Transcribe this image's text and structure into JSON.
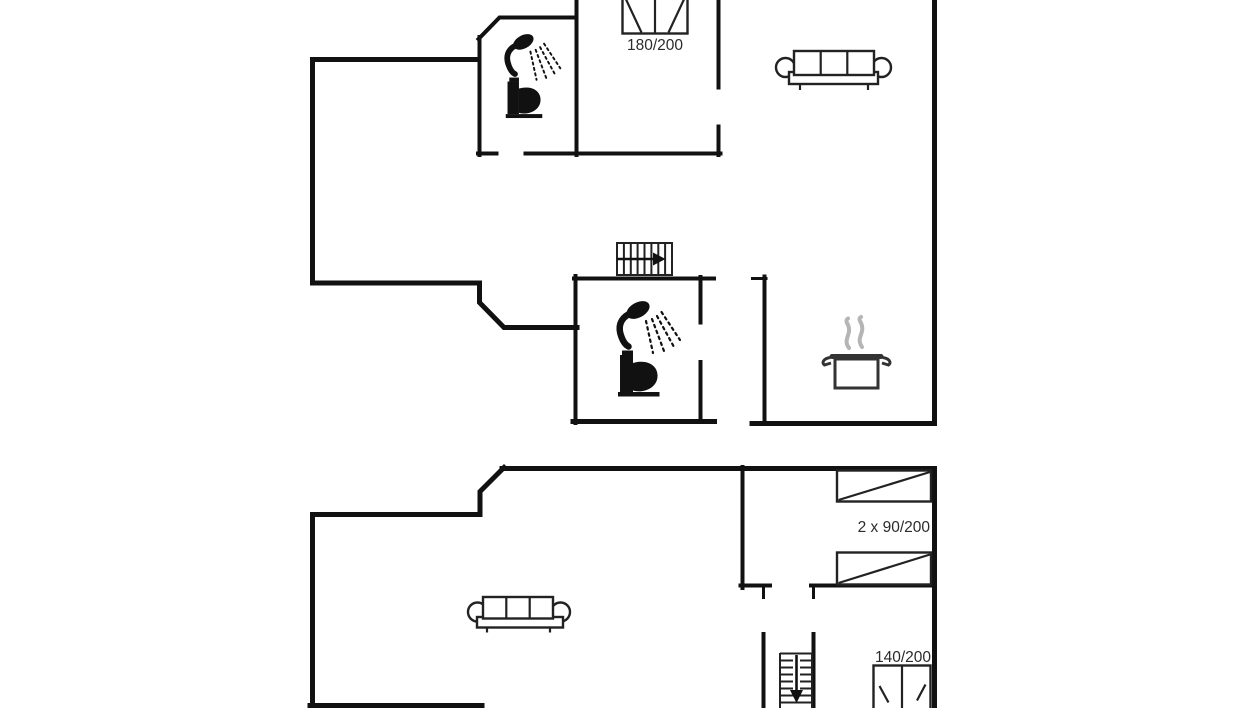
{
  "canvas": {
    "width": 1246,
    "height": 708,
    "background": "#ffffff"
  },
  "colors": {
    "wall": "#111111",
    "icon": "#111111",
    "furniture_outline": "#222222",
    "text": "#2b2b2b",
    "steam": "#b5b5b5",
    "pot_outline": "#333333"
  },
  "upper_floor": {
    "bed_double": {
      "size_label": "180/200",
      "icon": "double-bed-icon"
    },
    "bathroom_top": {
      "icons": [
        "shower-icon",
        "toilet-icon"
      ]
    },
    "bathroom_middle": {
      "icons": [
        "shower-icon",
        "toilet-icon"
      ]
    },
    "stairs": {
      "icon": "stairs-icon",
      "direction": "arrow-right"
    },
    "kitchen": {
      "icon": "cooking-pot-icon"
    },
    "living_area": {
      "icon": "sofa-icon"
    }
  },
  "lower_floor": {
    "bedroom_right": {
      "beds_label": "2 x 90/200",
      "icons": [
        "single-bed-icon",
        "single-bed-icon"
      ]
    },
    "bedroom_bottom": {
      "bed_label": "140/200",
      "icon": "double-bed-icon"
    },
    "stairs": {
      "icon": "stairs-icon",
      "direction": "arrow-down"
    },
    "living_area": {
      "icon": "sofa-icon"
    }
  }
}
